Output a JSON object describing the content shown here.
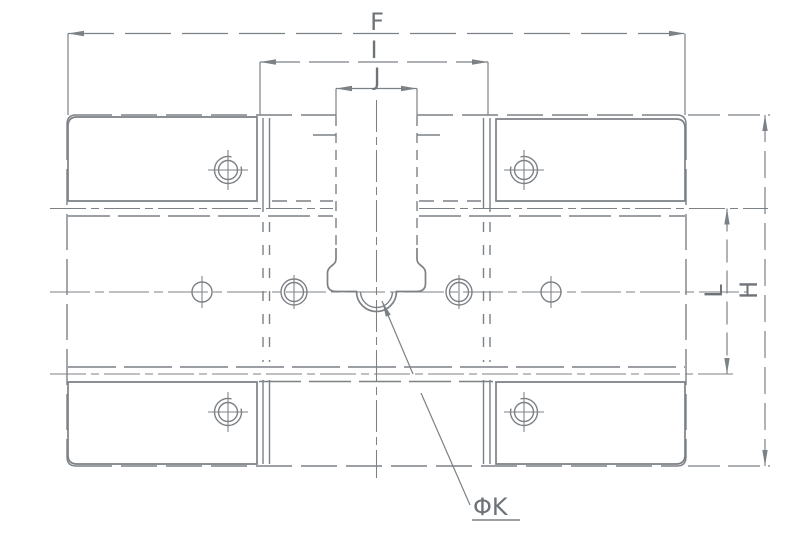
{
  "drawing": {
    "background": "#ffffff",
    "line_color": "#7c8186",
    "text_color": "#6e7378",
    "labels": {
      "overall_width": "F",
      "inner_width": "I",
      "slot_width": "J",
      "overall_height": "H",
      "rail_spacing": "L",
      "ball_diameter": "ΦK"
    }
  }
}
